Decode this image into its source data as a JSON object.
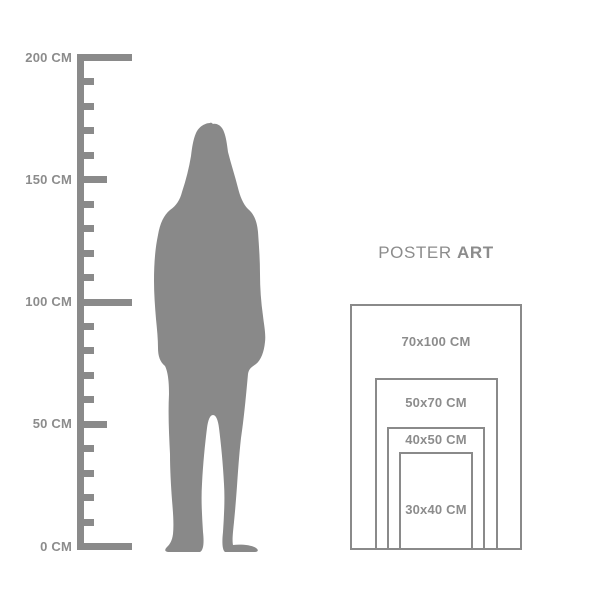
{
  "colors": {
    "ink": "#8a8a8a",
    "text": "#8c8c8c",
    "silhouette": "#898989",
    "background": "#ffffff"
  },
  "ruler": {
    "unit": "CM",
    "min": 0,
    "max": 200,
    "tick_step": 10,
    "long_tick_values": [
      0,
      100,
      200
    ],
    "medium_tick_values": [
      50,
      150
    ],
    "labeled_ticks": [
      {
        "value": 200,
        "label": "200 CM"
      },
      {
        "value": 150,
        "label": "150 CM"
      },
      {
        "value": 100,
        "label": "100 CM"
      },
      {
        "value": 50,
        "label": "50 CM"
      },
      {
        "value": 0,
        "label": "0 CM"
      }
    ]
  },
  "silhouette": {
    "description": "standing-woman-silhouette"
  },
  "poster": {
    "title_regular": "POSTER",
    "title_bold": "ART",
    "sizes": [
      {
        "label": "70x100 CM",
        "width_cm": 70,
        "height_cm": 100
      },
      {
        "label": "50x70 CM",
        "width_cm": 50,
        "height_cm": 70
      },
      {
        "label": "40x50 CM",
        "width_cm": 40,
        "height_cm": 50
      },
      {
        "label": "30x40 CM",
        "width_cm": 30,
        "height_cm": 40
      }
    ]
  }
}
